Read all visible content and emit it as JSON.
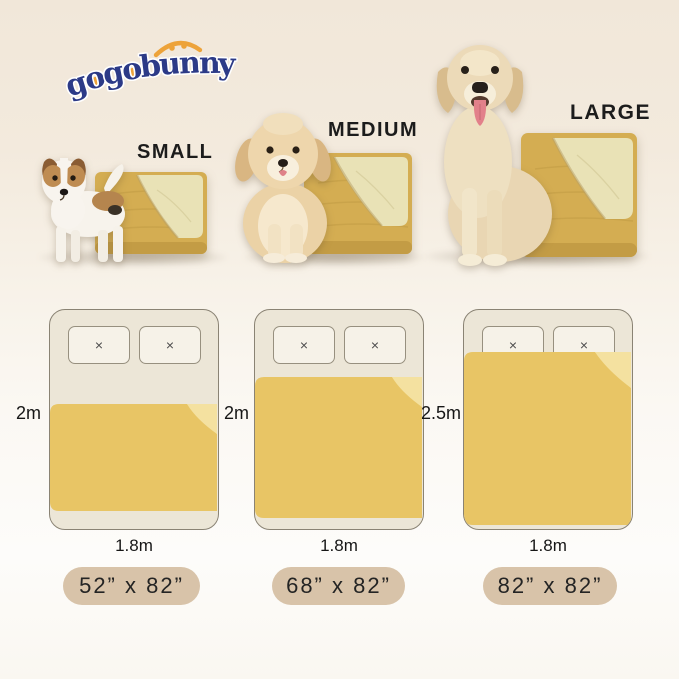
{
  "brand": {
    "name": "gogobunny",
    "letters": [
      "g",
      "o",
      "g",
      "o",
      "b",
      "u",
      "n",
      "n",
      "y"
    ]
  },
  "sections": [
    {
      "size": "SMALL",
      "bed": {
        "length": "2m",
        "width": "1.8m",
        "badge": "52” x 82”"
      }
    },
    {
      "size": "MEDIUM",
      "bed": {
        "length": "2m",
        "width": "1.8m",
        "badge": "68” x 82”"
      }
    },
    {
      "size": "LARGE",
      "bed": {
        "length": "2.5m",
        "width": "1.8m",
        "badge": "82” x 82”"
      }
    }
  ],
  "diagram": {
    "pillow_mark": "×"
  },
  "illustrations": {
    "small_dog": "jack-russell-puppy",
    "medium_dog": "fluffy-cream-puppy",
    "large_dog": "golden-retriever"
  },
  "colors": {
    "logo_navy": "#2c3a87",
    "logo_orange": "#eda33a",
    "photo_blanket_mustard": "#d4ad52",
    "photo_blanket_fold_cream": "#e9e2b6",
    "diagram_blanket_yellow": "#e8c565",
    "diagram_blanket_fold": "#f4e1a0",
    "bed_fill": "#ece6d7",
    "bed_outline": "#8a8374",
    "pillow_fill": "#f6f2e8",
    "badge_beige": "#d8c3a9",
    "text_dark": "#1c1c1c",
    "background_top": "#f1e7d9",
    "background_bottom": "#fdfcfa"
  }
}
